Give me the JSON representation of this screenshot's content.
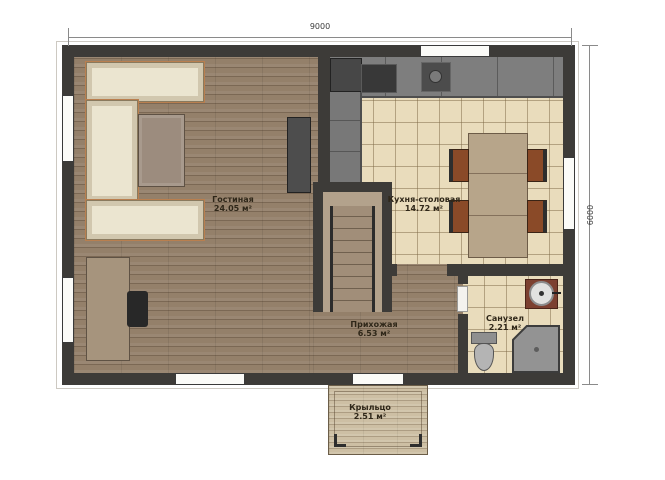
{
  "plan": {
    "type": "floor-plan-first-floor",
    "dimensions": {
      "width_mm": "9000",
      "depth_mm": "6000"
    },
    "rooms": [
      {
        "name": "Гостиная",
        "area": "24.05 м²"
      },
      {
        "name": "Кухня-столовая",
        "area": "14.72 м²"
      },
      {
        "name": "Прихожая",
        "area": "6.53 м²"
      },
      {
        "name": "Санузел",
        "area": "2.21 м²"
      },
      {
        "name": "Крыльцо",
        "area": "2.51 м²"
      }
    ],
    "furniture": [
      "corner-sofa",
      "coffee-table",
      "tv-console",
      "desk",
      "desk-chair",
      "kitchen-counter",
      "fridge",
      "cooktop",
      "kitchen-sink",
      "tall-cabinet",
      "dining-table",
      "dining-chairs-4",
      "staircase",
      "washbasin",
      "toilet",
      "corner-shower"
    ],
    "colors": {
      "wall": "#3d3b38",
      "wood_floor": "#94806a",
      "tile_floor": "#e9dcbc",
      "porch_floor": "#cdbfa4",
      "sofa": "#ebe5d0",
      "cabinet_gray": "#7e7e7e",
      "table_wood": "#b7a58a",
      "chair_brown": "#8a4a28",
      "vanity_brown": "#7c4030"
    }
  }
}
